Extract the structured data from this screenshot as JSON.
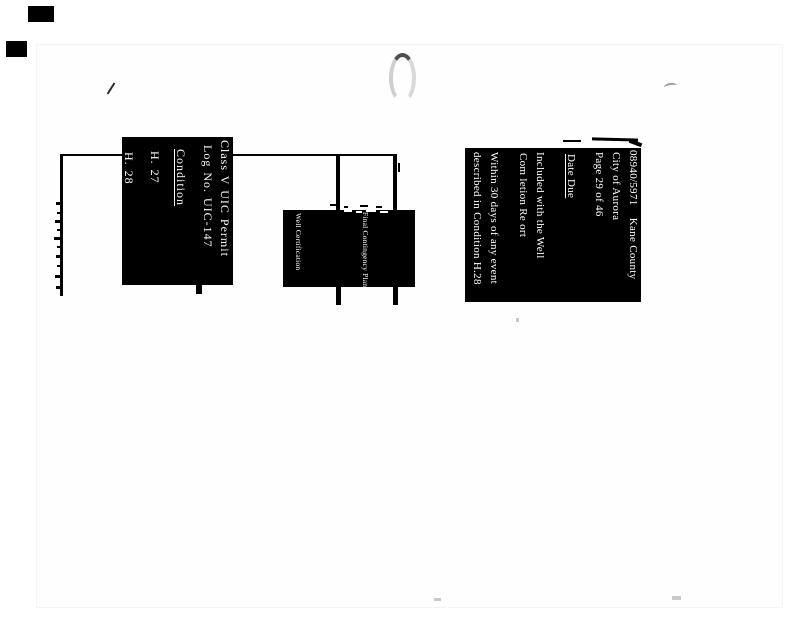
{
  "header_block": {
    "lines": [
      {
        "text": "08940/5971    Kane County"
      },
      {
        "text": "City of Aurora"
      },
      {
        "text": "Page 29 of 46"
      },
      {
        "text": "Date Due"
      },
      {
        "text": "Included with the Well"
      },
      {
        "text": "Com letion Re ort"
      },
      {
        "text": "Within 30 days of any event"
      },
      {
        "text": "described in Condition H.28"
      }
    ]
  },
  "permit_block": {
    "lines": [
      {
        "text": "Class V UIC Permit"
      },
      {
        "text": "Log No. UIC-147"
      },
      {
        "text": "Condition"
      },
      {
        "text": "H. 27"
      },
      {
        "text": "H. 28"
      }
    ]
  },
  "requirement_block": {
    "lines": [
      {
        "text": "Final Contingency Plan"
      },
      {
        "text": "Well Certification"
      }
    ]
  },
  "colors": {
    "ink": "#000000",
    "paper": "#ffffff",
    "scan_gray": "#4f4f4f"
  }
}
